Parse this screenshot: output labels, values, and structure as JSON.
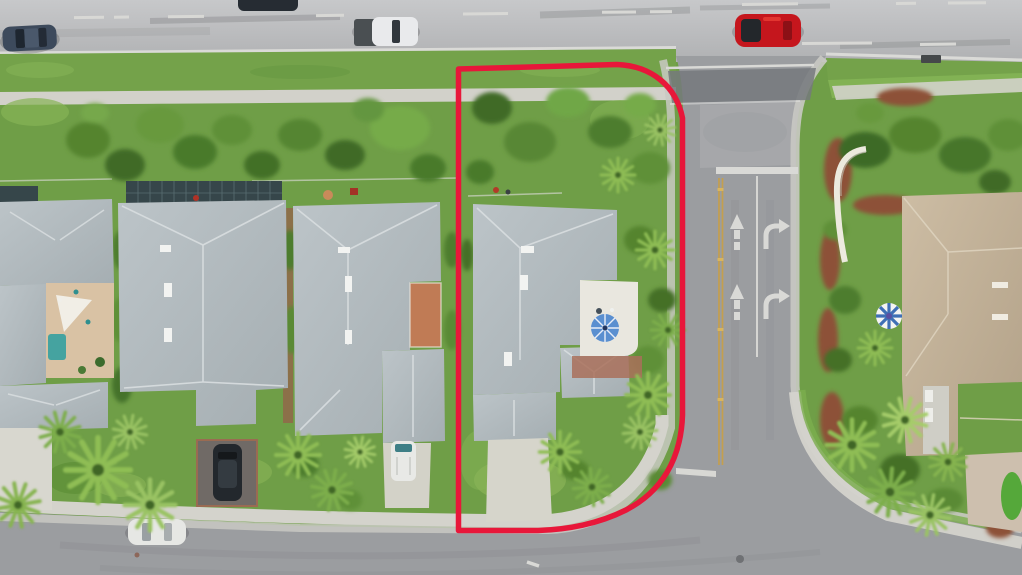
{
  "scene": {
    "kind": "aerial-drone-photo",
    "subject": "corner residential lot outlined in red beside a community side street and main road"
  },
  "palette": {
    "vegetation_base": "#6f9e47",
    "main_road_asphalt": "#bdbec0",
    "local_road_asphalt": "#9b9da0",
    "sidewalk_concrete": "#d4d3cc",
    "gutter_concrete": "#c9c9c3",
    "boundary_red": "#e8173a",
    "center_line_yellow": "#c49f4e",
    "marking_white": "#d9d9d6",
    "roof_gray": "#b0b9bd",
    "roof_tan": "#c6b49b",
    "grass_lawn": "#7da751",
    "canopy_dark": "#3f6b26",
    "canopy_mid": "#55842f",
    "canopy_light": "#76ab49",
    "palm_green": "#8fbd55",
    "mulch_red": "#8d5137",
    "courtyard_terracotta": "#c07b55",
    "patio_white": "#e9e7df",
    "pool_teal": "#45a3a0",
    "umbrella_blue": "#5a8fd0",
    "umbrella_striped_blue": "#3f6fb5"
  },
  "objects": {
    "boundary": "red-property-outline",
    "roads": [
      "main-road-top",
      "side-street-right",
      "bottom-street"
    ],
    "road_markings": [
      "dashed-lane-lines",
      "solid-edge-lines",
      "double-yellow-center-line",
      "stop-bars",
      "straight-arrows",
      "right-turn-arrows",
      "white-lane-divider"
    ],
    "vehicles": [
      "dark-sedan-main-road",
      "partial-car-top-edge",
      "white-pickup-main-road",
      "red-car-main-road",
      "dark-suv-driveway",
      "white-van-driveway",
      "white-car-bottom-street"
    ],
    "houses": [
      "house-left-partial-with-pool-court",
      "house-two-gray-roof",
      "house-three-gray-roof-terracotta-court",
      "outlined-house-gray-roof-patio-umbrella",
      "house-right-tan-roof"
    ],
    "landscape": [
      "tree-canopy",
      "palm-trees",
      "lawns",
      "red-mulch-beds",
      "entrance-monument-wall",
      "putting-green"
    ]
  }
}
